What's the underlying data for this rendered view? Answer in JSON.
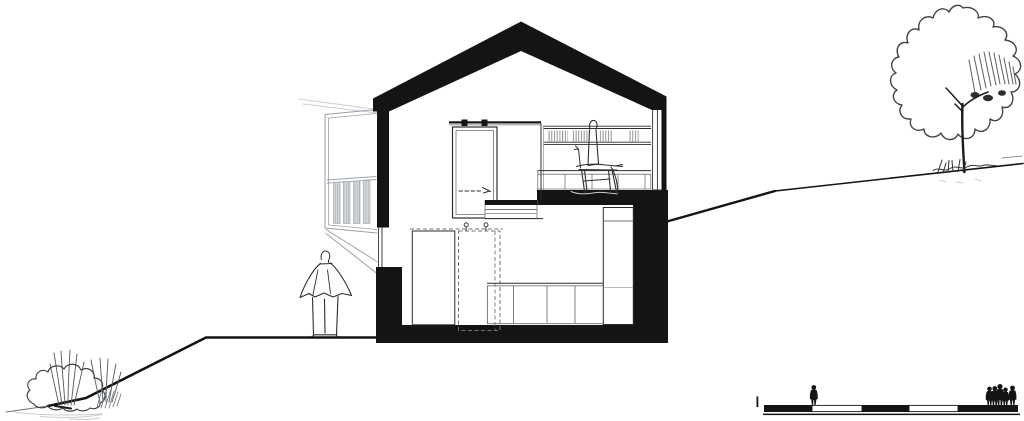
{
  "colors": {
    "paper": "#ffffff",
    "ink": "#141414",
    "sketch-dark": "#2b2d2f",
    "line-mid": "#6f7478",
    "line-light": "#9aa1a7",
    "line-faint": "#c9ced3",
    "panel": "#d9dde0"
  },
  "drawing": {
    "kind": "architectural-section",
    "house": [
      "gable-roof",
      "left-wall-with-window",
      "right-glazed-wall",
      "upper-floor-slab",
      "ground-slab",
      "split-level-steps"
    ],
    "upper_floor": [
      "sliding-door",
      "door-track",
      "opening-direction-arrow",
      "bookshelf-with-books",
      "sideboard",
      "sketched-chair"
    ],
    "lower_floor": [
      "wardrobe",
      "dashed-wardrobe-outline",
      "hanger-hooks",
      "kitchen-counter",
      "tall-cabinet"
    ],
    "exterior": [
      "balcony-screen",
      "balcony-struts",
      "standing-person",
      "tree",
      "bush-with-grasses",
      "ground-line-left",
      "ground-line-right"
    ],
    "scale_bar": {
      "pattern": [
        "filled",
        "empty",
        "filled",
        "empty",
        "filled"
      ],
      "left_tick": 1,
      "single_figure": 1,
      "group_figures": 5
    }
  }
}
